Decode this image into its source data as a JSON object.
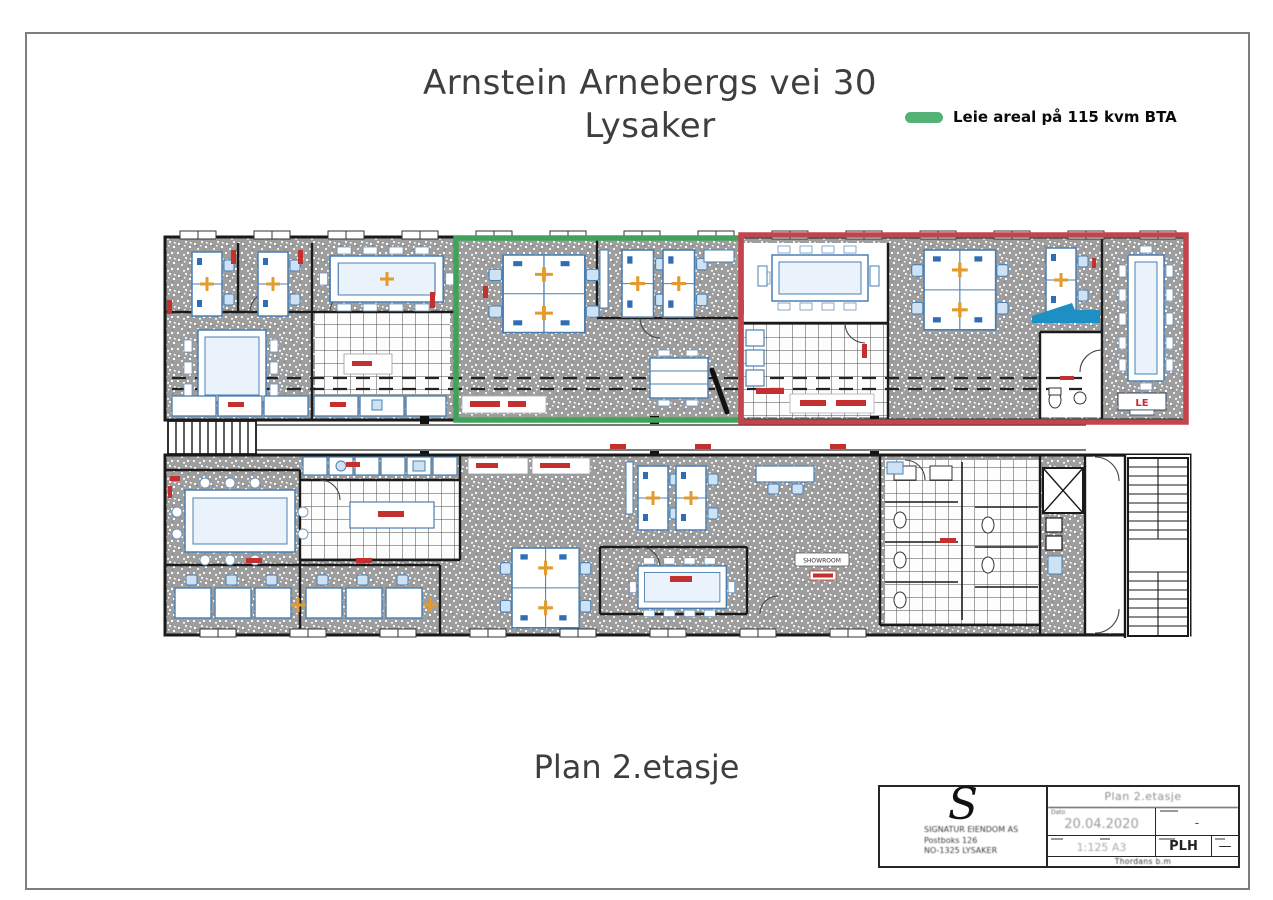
{
  "page": {
    "title_line1": "Arnstein Arnebergs vei 30",
    "title_line2": "Lysaker",
    "caption": "Plan 2.etasje"
  },
  "legend": {
    "label": "Leie areal på 115 kvm BTA",
    "swatch_color": "#53b377"
  },
  "plan": {
    "labels": {
      "le_room": "LE",
      "showroom": "SHOWROOM"
    },
    "overlays": {
      "leased_green_color": "#3fa35a",
      "red_area_color": "#c4444e"
    },
    "colors": {
      "wall": "#1a1a1a",
      "carpet_gray": "#9e9e9e",
      "furniture_blue": "#4a7fb0",
      "furniture_fill": "#eaf3fb",
      "accent_orange": "#e39b2d",
      "label_red": "#c43030",
      "highlight_blue": "#1d8fc4"
    }
  },
  "title_block": {
    "company": {
      "logo_letter": "S",
      "name": "SIGNATUR EIENDOM AS",
      "address1": "Postboks 126",
      "address2": "NO-1325 LYSAKER"
    },
    "drawing_title": "Plan 2.etasje",
    "fields": {
      "date_label": "Dato",
      "date": "20.04.2020",
      "measure_value": "-",
      "scale_format": "1:125 A3",
      "drawn_by": "PLH",
      "revision": "—",
      "footer_text": "Thordans b.m"
    }
  }
}
